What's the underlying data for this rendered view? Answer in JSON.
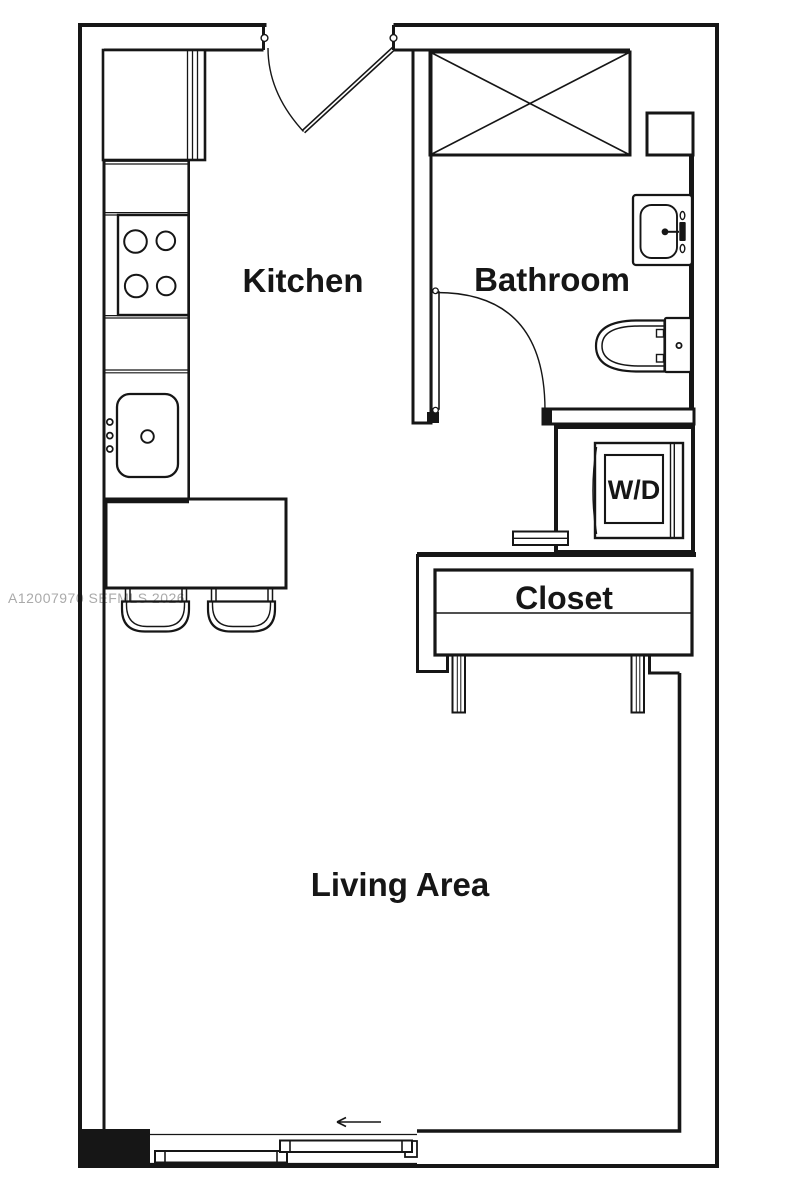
{
  "title": "Studio apartment floor plan",
  "colors": {
    "background": "#ffffff",
    "lines": "#161616",
    "watermark": "#aaaaaa"
  },
  "labels": {
    "kitchen": "Kitchen",
    "bathroom": "Bathroom",
    "closet": "Closet",
    "living_area": "Living Area",
    "washer_dryer": "W/D"
  },
  "watermark": "A12007970 SEFMLS 2026",
  "fixtures": [
    "refrigerator",
    "range-4-burner",
    "kitchen-sink",
    "breakfast-counter",
    "bar-stool",
    "bar-stool",
    "entry-door",
    "shower",
    "shower-niche",
    "vanity-sink",
    "toilet",
    "bathroom-door",
    "washer-dryer",
    "wall-shelf",
    "closet-rod",
    "sliding-closet-door-panel",
    "sliding-closet-door-panel",
    "sliding-glass-door",
    "slide-direction-arrow"
  ]
}
